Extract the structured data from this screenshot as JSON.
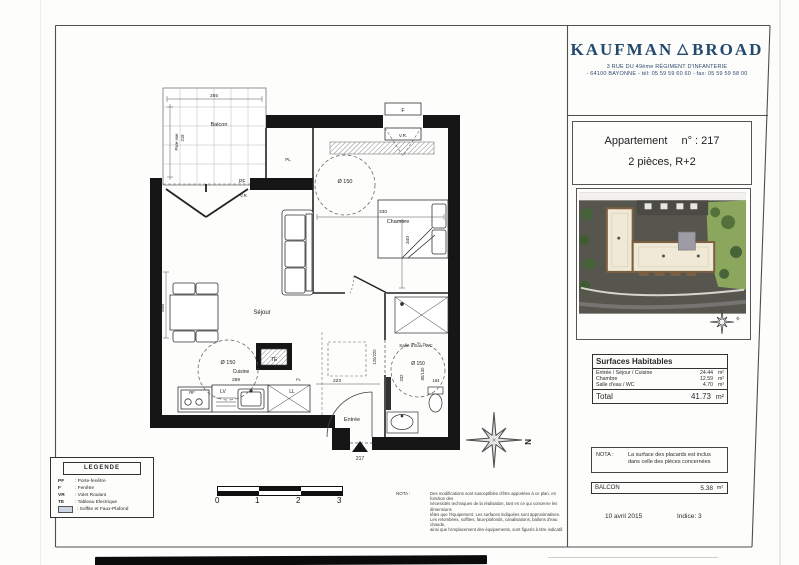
{
  "colors": {
    "brand_navy": "#24496e",
    "line": "#2e2e2e",
    "legend_swatch": "#ccd3e3"
  },
  "brand": {
    "name_left": "KAUFMAN",
    "triangle": "△",
    "name_right": "BROAD",
    "address_line1": "3 RUE DU 49ème RÉGIMENT D'INFANTERIE",
    "address_line2": "- 64100 BAYONNE - tél: 05 59 59 60 60 - fax: 05 59 59 58 00"
  },
  "apartment": {
    "label": "Appartement",
    "number": "n° : 217",
    "type_floor": "2 pièces, R+2"
  },
  "site_plan": {
    "compass_letter": "N"
  },
  "surfaces": {
    "title": "Surfaces Habitables",
    "rows": [
      {
        "label": "Entrée / Séjour / Cuisine",
        "value": "24.44",
        "unit": "m²"
      },
      {
        "label": "Chambre",
        "value": "12.59",
        "unit": "m²"
      },
      {
        "label": "Salle d'eau / WC",
        "value": "4.70",
        "unit": "m²"
      }
    ],
    "total_label": "Total",
    "total_value": "41.73",
    "total_unit": "m²"
  },
  "nota_right": {
    "label": "NOTA :",
    "text": "La surface des placards est inclus dans celle des pièces concernées"
  },
  "balcon_row": {
    "label": "BALCON",
    "value": "5.38",
    "unit": "m²"
  },
  "footer": {
    "date": "10 avril 2015",
    "indice": "Indice: 3"
  },
  "legend": {
    "title": "LEGENDE",
    "items": [
      {
        "abbr": "PF",
        "label": ": Porte-fenêtre"
      },
      {
        "abbr": "F",
        "label": ": Fenêtre"
      },
      {
        "abbr": "VR",
        "label": ": Volet Roulant"
      },
      {
        "abbr": "TE",
        "label": ": Tableau Electrique"
      },
      {
        "abbr": "",
        "label": ": Soffite et Faux-Plafond"
      }
    ]
  },
  "scale_bar": {
    "ticks": [
      "0",
      "1",
      "2",
      "3"
    ]
  },
  "nota_small": {
    "label": "NOTA :",
    "lines": [
      "Des modifications sont susceptibles d'être apportées à ce plan, en fonction des",
      "nécessités techniques de la réalisation, tant en ce qui concerne les dimensions",
      "têtes que l'équipement. Les surfaces indiquées sont approximatives.",
      "Les retombées, soffites, faux-plafonds, canalisations, ballons d'eau chaude,",
      "ainsi que l'emplacement des équipements, sont figurés à titre indicatif."
    ]
  },
  "plan": {
    "balcon": "Balcon",
    "dim_balcon": "255",
    "pare_vue": "Pare-vue",
    "dim_pare_vue": "219",
    "pf": "PF",
    "vr_pf": "V.R.",
    "window_f": "F",
    "window_vr": "V.R.",
    "pl_top": "PL",
    "pl_kitchen": "PL",
    "sejour": "Séjour",
    "dim_sejour": "546",
    "circle": "Ø 150",
    "cuisine": "Cuisine",
    "dim_cuisine": "289",
    "chambre": "Chambre",
    "dim_chambre_w": "330",
    "dim_chambre_h": "340",
    "te": "TE",
    "rf": "RF",
    "four": "(four)",
    "lv": "LV",
    "ll": "LL",
    "bath": "Salle d'Eau+WC",
    "dim_bath_1": "332",
    "dim_bath_2": "80/130",
    "dim_bath_3": "164",
    "dim_hall": "223",
    "dim_door": "120/220",
    "entree": "Entrée",
    "door_number": "217",
    "compass_letter": "N"
  }
}
